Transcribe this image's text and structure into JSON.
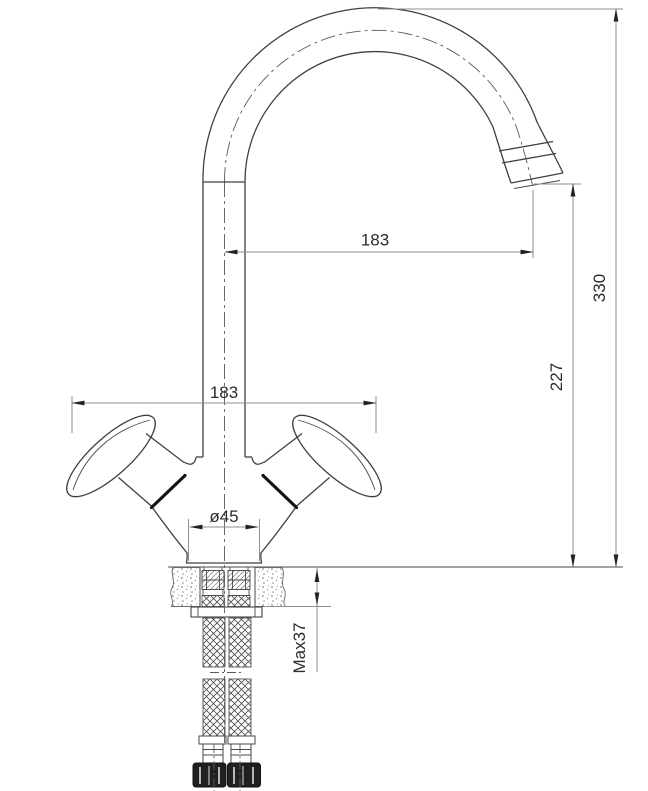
{
  "drawing": {
    "type": "faucet-installation-dimension-drawing",
    "view": "side-elevation",
    "dimensions": {
      "spout_reach": "183",
      "overall_height": "330",
      "outlet_height": "227",
      "handle_span": "183",
      "base_diameter": "ø45",
      "max_counter_thickness": "Max37"
    },
    "colors": {
      "background": "#ffffff",
      "object_line": "#404040",
      "bold_line": "#141414",
      "dimension_line": "#8f8f8f",
      "text": "#2b2b2b",
      "nut_fill": "#202020"
    }
  }
}
